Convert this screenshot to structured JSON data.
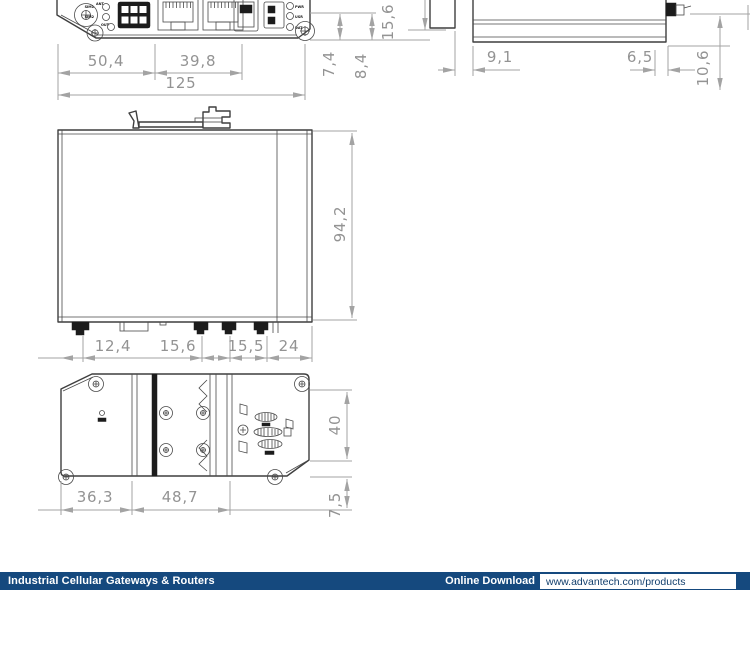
{
  "drawing": {
    "line_color": "#3f3f3f",
    "dim_color": "#a3a3a3",
    "front_view": {
      "dims": {
        "width_left": "50,4",
        "width_mid": "39,8",
        "width_total": "125",
        "depth_a": "7,4",
        "depth_b": "8,4",
        "depth_total": "15,6"
      },
      "labels": {
        "ant": "ANT",
        "sim1": "SIM1",
        "sim2": "SIM2",
        "out": "OUT",
        "pwr": "PWR",
        "usr": "USR",
        "dat": "DAT"
      }
    },
    "side_view": {
      "dims": {
        "clip_offset": "9,1",
        "conn_offset": "6,5",
        "conn_height": "10,6"
      }
    },
    "profile_view": {
      "dims": {
        "height": "94,2",
        "seg_a": "12,4",
        "seg_b": "15,6",
        "seg_c": "15,5",
        "seg_d": "24"
      }
    },
    "rear_view": {
      "dims": {
        "edge_to_rail": "36,3",
        "rail_width": "48,7",
        "rail_height": "40",
        "foot": "7,5"
      }
    }
  },
  "footer": {
    "bar_color": "#15497e",
    "category": "Industrial Cellular Gateways & Routers",
    "download_label": "Online Download",
    "url": "www.advantech.com/products"
  }
}
